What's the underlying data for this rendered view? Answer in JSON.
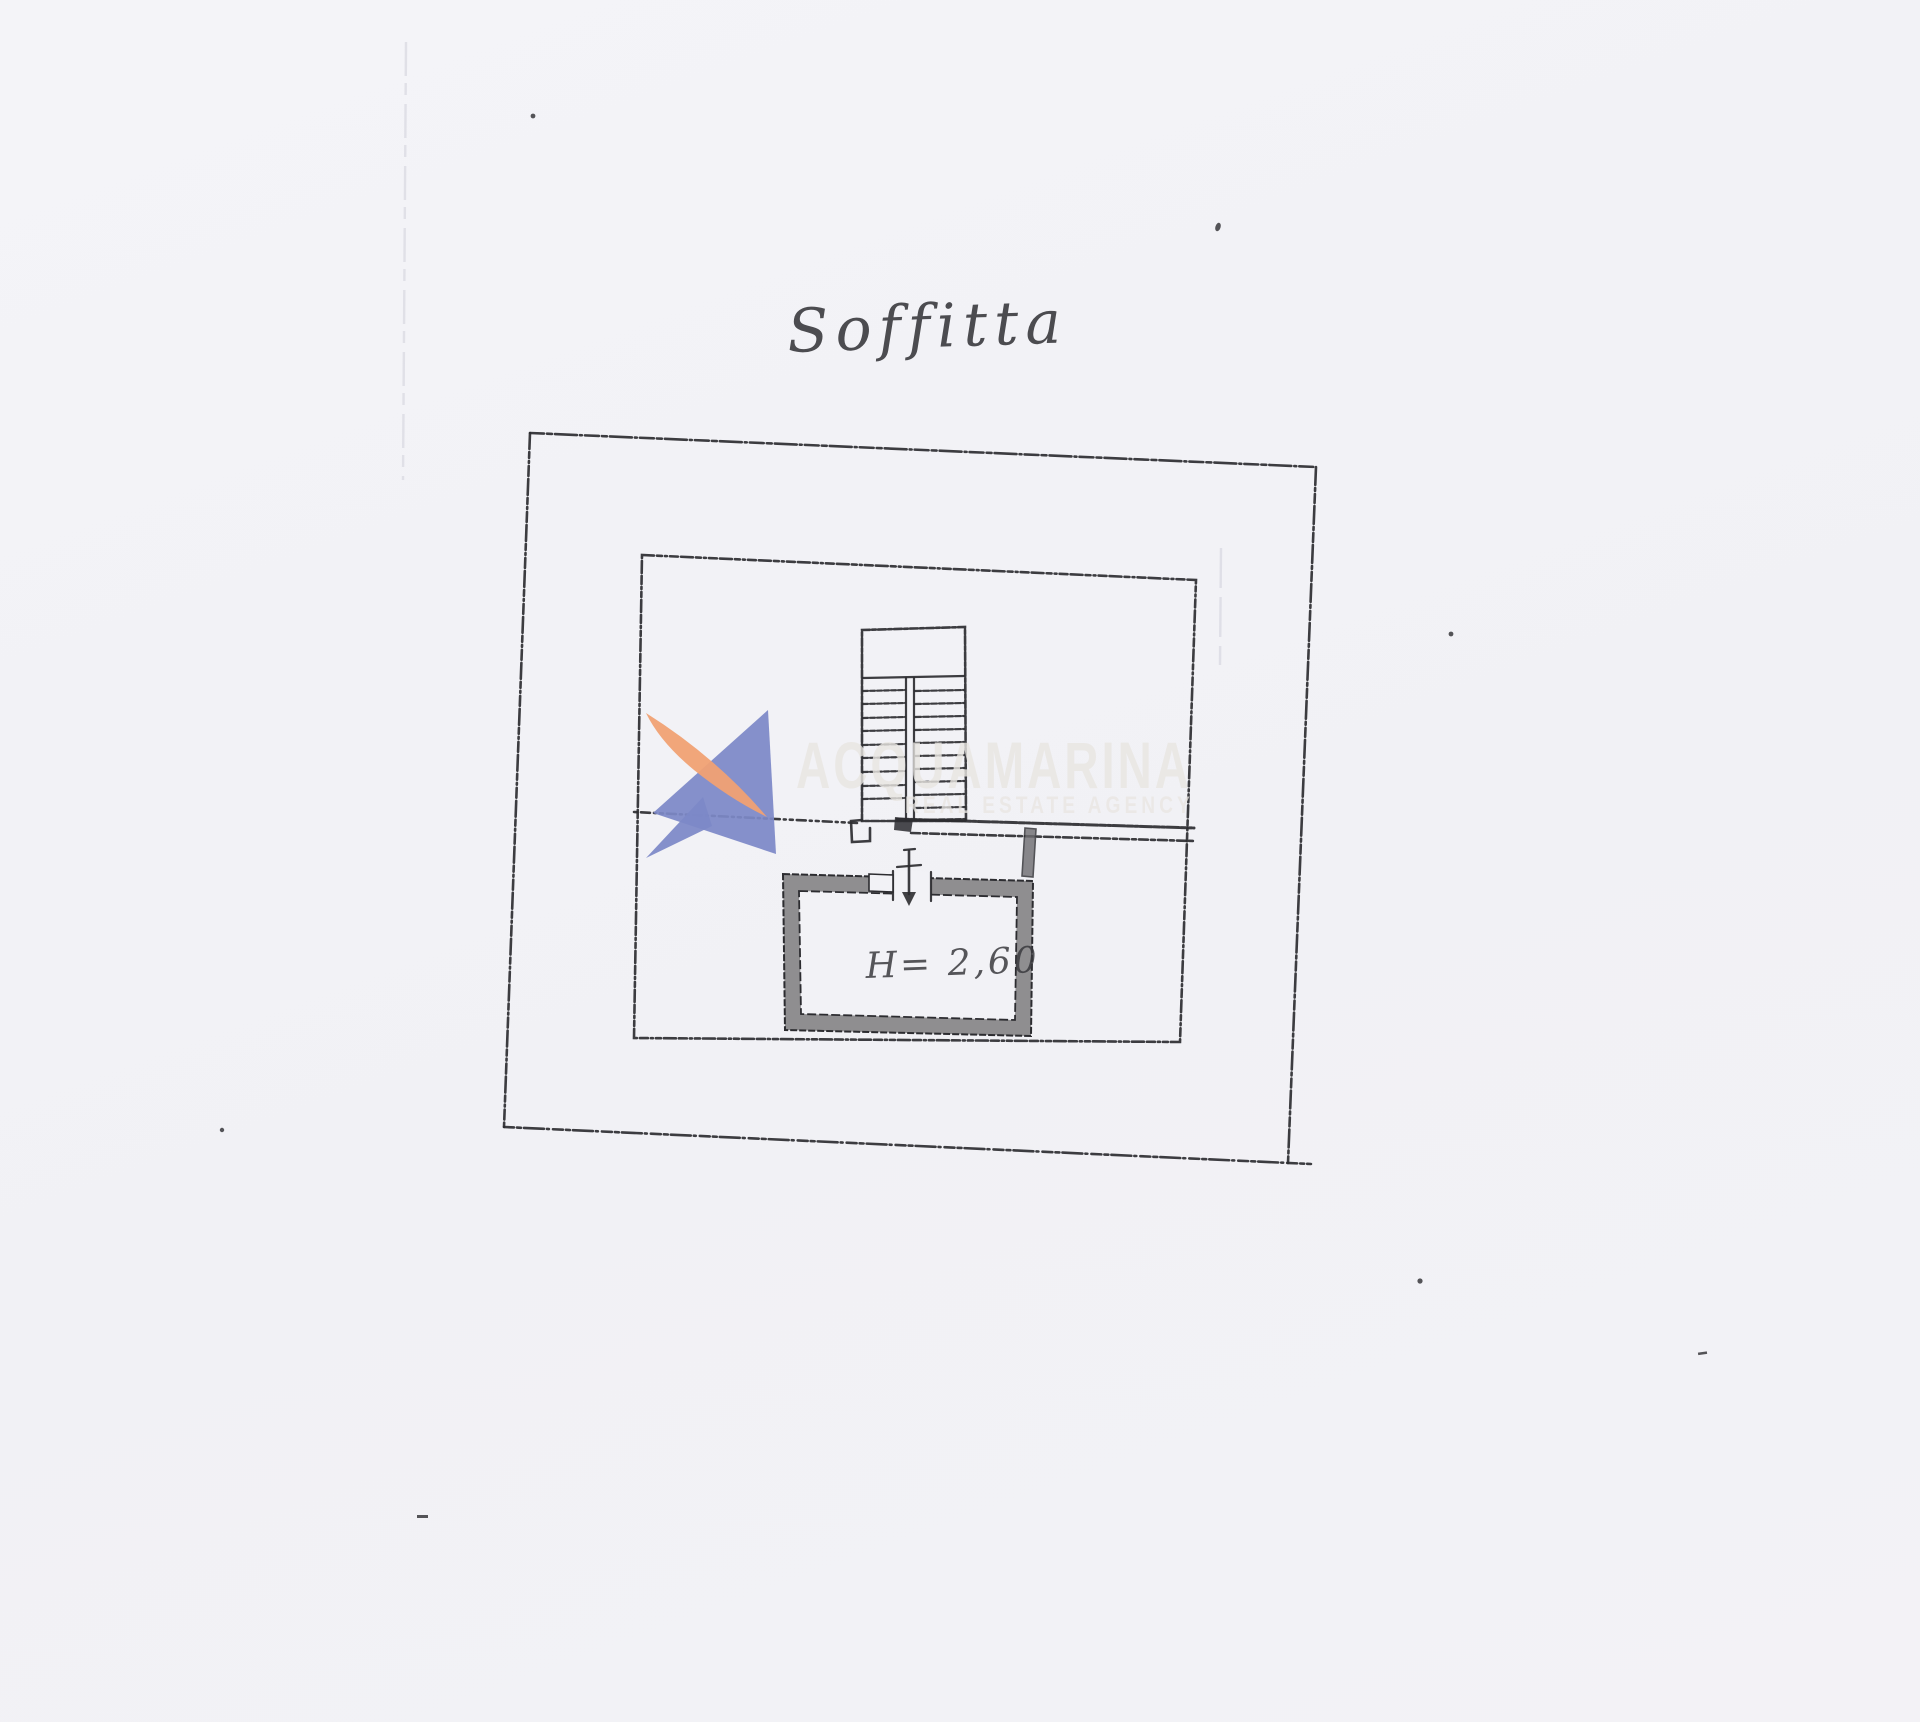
{
  "title": "Soffitta",
  "room": {
    "height_label": "H= 2,60"
  },
  "watermark": {
    "name": "ACQUAMARINA",
    "tagline": "REAL ESTATE AGENCY"
  },
  "colors": {
    "paper": "#f2f2f6",
    "ink": "#2c2c30",
    "wall": "#8f8e90",
    "wall-dark": "#6d6c70",
    "brand-orange": "#f0a173",
    "brand-blue": "#7d89c7",
    "wm-text": "#e9e6e2",
    "faint": "#dcdce4"
  }
}
